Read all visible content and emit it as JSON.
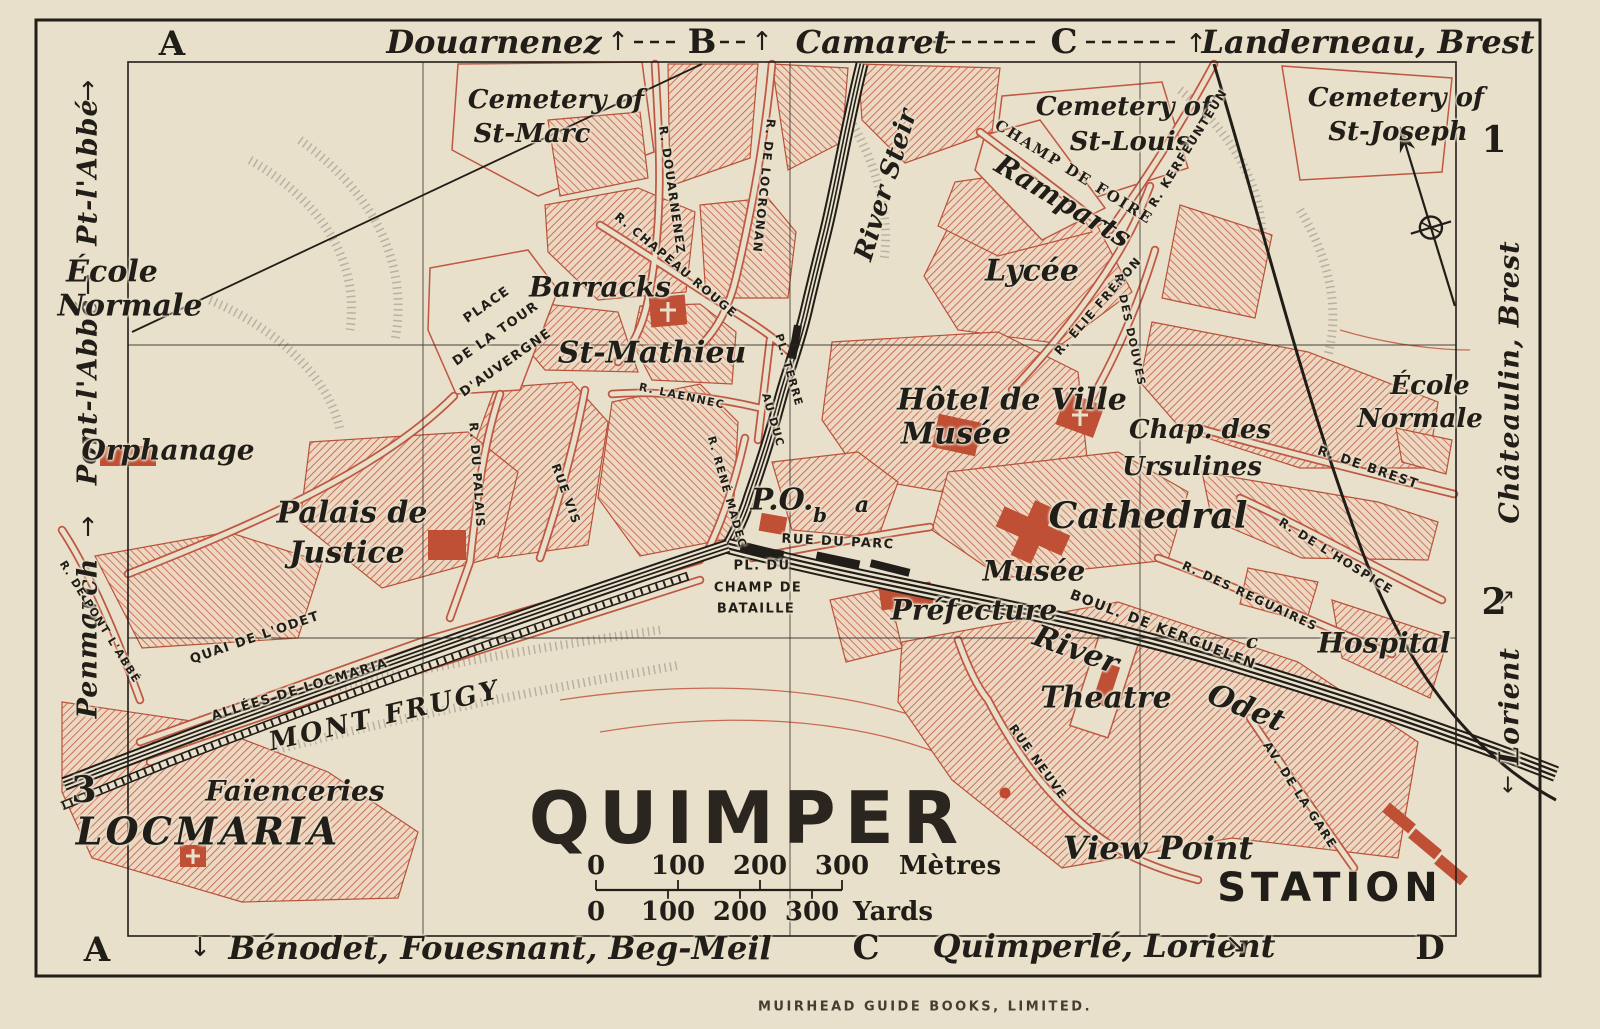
{
  "title": "QUIMPER",
  "publisher": "MUIRHEAD GUIDE BOOKS, LIMITED.",
  "colors": {
    "paper": "#e9e0cb",
    "ink": "#211d18",
    "street_red": "#bf5742",
    "hatch_red": "#c2573e",
    "building_red": "#bf4f35"
  },
  "scale": {
    "metres": {
      "ticks": [
        "0",
        "100",
        "200",
        "300"
      ],
      "unit": "Mètres"
    },
    "yards": {
      "ticks": [
        "0",
        "100",
        "200",
        "300"
      ],
      "unit": "Yards"
    }
  },
  "labels": [
    {
      "n": "grid-letter-a-top",
      "t": "A",
      "c": "g",
      "x": 172,
      "y": 44
    },
    {
      "n": "edge-douarnenez",
      "t": "Douarnenez",
      "c": "e",
      "x": 494,
      "y": 42
    },
    {
      "n": "arrow-up-douarnenez",
      "t": "↑",
      "c": "ar",
      "x": 618,
      "y": 42
    },
    {
      "n": "grid-letter-b-top",
      "t": "B",
      "c": "g",
      "x": 702,
      "y": 42
    },
    {
      "n": "arrow-up-camaret",
      "t": "↑",
      "c": "ar",
      "x": 762,
      "y": 42
    },
    {
      "n": "edge-camaret",
      "t": "Camaret",
      "c": "e",
      "x": 872,
      "y": 42
    },
    {
      "n": "grid-letter-c-top",
      "t": "C",
      "c": "g",
      "x": 1064,
      "y": 42
    },
    {
      "n": "arrow-up-landerneau",
      "t": "↑",
      "c": "ar",
      "x": 1196,
      "y": 44
    },
    {
      "n": "edge-landerneau-brest",
      "t": "Landerneau, Brest",
      "c": "e",
      "x": 1368,
      "y": 42
    },
    {
      "n": "grid-letter-a-bottom",
      "t": "A",
      "c": "g",
      "x": 97,
      "y": 950
    },
    {
      "n": "arrow-down-benodet",
      "t": "↓",
      "c": "ar",
      "x": 200,
      "y": 948
    },
    {
      "n": "edge-benodet",
      "t": "Bénodet, Fouesnant, Beg-Meil",
      "c": "e",
      "x": 500,
      "y": 948
    },
    {
      "n": "grid-letter-c-bottom",
      "t": "C",
      "c": "g",
      "x": 866,
      "y": 948
    },
    {
      "n": "edge-quimperle-lorient",
      "t": "Quimperlé, Lorient",
      "c": "e",
      "x": 1104,
      "y": 946
    },
    {
      "n": "arrow-se-quimperle",
      "t": "↘",
      "c": "ar",
      "x": 1236,
      "y": 944
    },
    {
      "n": "grid-letter-d-bottom",
      "t": "D",
      "c": "g",
      "x": 1430,
      "y": 948
    },
    {
      "n": "edge-pt-labbe",
      "t": "Pt-l'Abbé",
      "c": "v",
      "x": 88,
      "y": 172,
      "r": -90
    },
    {
      "n": "arrow-up-pt-labbe",
      "t": "↑",
      "c": "ar",
      "x": 88,
      "y": 92
    },
    {
      "n": "edge-pont-labbe",
      "t": "Pont-l'Abbé",
      "c": "v",
      "x": 88,
      "y": 392,
      "r": -90
    },
    {
      "n": "arrow-up-pont-labbe",
      "t": "↑",
      "c": "ar",
      "x": 88,
      "y": 286
    },
    {
      "n": "edge-penmarch",
      "t": "Penmarch",
      "c": "v",
      "x": 88,
      "y": 638,
      "r": -90
    },
    {
      "n": "arrow-up-penmarch",
      "t": "↑",
      "c": "ar",
      "x": 88,
      "y": 528
    },
    {
      "n": "row-number-3",
      "t": "3",
      "c": "n",
      "x": 84,
      "y": 790
    },
    {
      "n": "row-number-1",
      "t": "1",
      "c": "n",
      "x": 1494,
      "y": 140
    },
    {
      "n": "edge-chateaulin-brest",
      "t": "Châteaulin, Brest",
      "c": "v",
      "x": 1510,
      "y": 382,
      "r": -90
    },
    {
      "n": "arrow-chateaulin",
      "t": "↗",
      "c": "ar",
      "x": 1506,
      "y": 598,
      "s": 22
    },
    {
      "n": "row-number-2",
      "t": "2",
      "c": "n",
      "x": 1494,
      "y": 602
    },
    {
      "n": "edge-lorient",
      "t": "Lorient",
      "c": "v",
      "x": 1510,
      "y": 706,
      "r": -90
    },
    {
      "n": "arrow-down-lorient",
      "t": "↓",
      "c": "ar",
      "x": 1508,
      "y": 786,
      "s": 22
    },
    {
      "n": "cemetery-st-marc-line1",
      "t": "Cemetery of",
      "c": "p",
      "x": 556,
      "y": 100
    },
    {
      "n": "cemetery-st-marc-line2",
      "t": "St-Marc",
      "c": "p",
      "x": 532,
      "y": 134
    },
    {
      "n": "cemetery-st-louis-line1",
      "t": "Cemetery of",
      "c": "p",
      "x": 1124,
      "y": 107
    },
    {
      "n": "cemetery-st-louis-line2",
      "t": "St-Louis",
      "c": "p",
      "x": 1130,
      "y": 142
    },
    {
      "n": "cemetery-st-joseph-line1",
      "t": "Cemetery of",
      "c": "p",
      "x": 1396,
      "y": 98
    },
    {
      "n": "cemetery-st-joseph-line2",
      "t": "St-Joseph",
      "c": "p",
      "x": 1398,
      "y": 132
    },
    {
      "n": "ecole-normale-west-line1",
      "t": "École",
      "c": "p",
      "x": 112,
      "y": 272,
      "s": 30
    },
    {
      "n": "ecole-normale-west-line2",
      "t": "Normale",
      "c": "p",
      "x": 130,
      "y": 306,
      "s": 30
    },
    {
      "n": "orphanage",
      "t": "Orphanage",
      "c": "p",
      "x": 168,
      "y": 450,
      "s": 28
    },
    {
      "n": "palais-de-justice-line1",
      "t": "Palais de",
      "c": "p",
      "x": 352,
      "y": 513,
      "s": 30
    },
    {
      "n": "palais-de-justice-line2",
      "t": "Justice",
      "c": "p",
      "x": 347,
      "y": 553,
      "s": 30
    },
    {
      "n": "barracks",
      "t": "Barracks",
      "c": "p",
      "x": 600,
      "y": 287,
      "s": 28
    },
    {
      "n": "st-mathieu",
      "t": "St-Mathieu",
      "c": "p",
      "x": 652,
      "y": 353,
      "s": 30
    },
    {
      "n": "hotel-de-ville",
      "t": "Hôtel de Ville",
      "c": "p",
      "x": 1012,
      "y": 400,
      "s": 30
    },
    {
      "n": "musee-hotel-de-ville",
      "t": "Musée",
      "c": "p",
      "x": 956,
      "y": 434,
      "s": 30
    },
    {
      "n": "chap-des-ursulines-line1",
      "t": "Chap. des",
      "c": "p",
      "x": 1200,
      "y": 430
    },
    {
      "n": "chap-des-ursulines-line2",
      "t": "Ursulines",
      "c": "p",
      "x": 1192,
      "y": 467
    },
    {
      "n": "cathedral",
      "t": "Cathedral",
      "c": "p",
      "x": 1148,
      "y": 516,
      "s": 36
    },
    {
      "n": "musee-south",
      "t": "Musée",
      "c": "p",
      "x": 1034,
      "y": 571,
      "s": 28
    },
    {
      "n": "prefecture",
      "t": "Préfecture",
      "c": "p",
      "x": 974,
      "y": 610,
      "s": 28
    },
    {
      "n": "hospital",
      "t": "Hospital",
      "c": "p",
      "x": 1384,
      "y": 643,
      "s": 28
    },
    {
      "n": "theatre",
      "t": "Theatre",
      "c": "p",
      "x": 1106,
      "y": 698,
      "s": 30
    },
    {
      "n": "lycee",
      "t": "Lycée",
      "c": "p",
      "x": 1032,
      "y": 271,
      "s": 30
    },
    {
      "n": "ecole-normale-east-line1",
      "t": "École",
      "c": "p",
      "x": 1430,
      "y": 386
    },
    {
      "n": "ecole-normale-east-line2",
      "t": "Normale",
      "c": "p",
      "x": 1420,
      "y": 419
    },
    {
      "n": "faiencieries",
      "t": "Faïenceries",
      "c": "p",
      "x": 295,
      "y": 791,
      "s": 28
    },
    {
      "n": "view-point",
      "t": "View Point",
      "c": "p",
      "x": 1158,
      "y": 848,
      "s": 32
    },
    {
      "n": "ramparts",
      "t": "Ramparts",
      "c": "p",
      "x": 1063,
      "y": 201,
      "r": 31,
      "s": 28
    },
    {
      "n": "river-steir",
      "t": "River Steir",
      "c": "p",
      "x": 886,
      "y": 185,
      "r": -73
    },
    {
      "n": "river-odet-word1",
      "t": "River",
      "c": "p",
      "x": 1076,
      "y": 650,
      "r": 20,
      "s": 30
    },
    {
      "n": "river-odet-word2",
      "t": "Odet",
      "c": "p",
      "x": 1246,
      "y": 708,
      "r": 22,
      "s": 30
    },
    {
      "n": "mont-frugy",
      "t": "MONT FRUGY",
      "c": "cap",
      "x": 385,
      "y": 716,
      "r": -13
    },
    {
      "n": "locmaria",
      "t": "LOCMARIA",
      "c": "big",
      "x": 208,
      "y": 831
    },
    {
      "n": "station",
      "t": "STATION",
      "c": "sta",
      "x": 1330,
      "y": 888
    },
    {
      "n": "post-office",
      "t": "P.O.",
      "c": "p",
      "x": 782,
      "y": 500,
      "s": 30
    },
    {
      "n": "marker-a",
      "t": "a",
      "c": "sm",
      "x": 862,
      "y": 505,
      "s": 22
    },
    {
      "n": "marker-b",
      "t": "b",
      "c": "sm",
      "x": 820,
      "y": 515
    },
    {
      "n": "marker-c",
      "t": "c",
      "c": "sm",
      "x": 1252,
      "y": 641
    },
    {
      "n": "champ-de-foire",
      "t": "CHAMP DE FOIRE",
      "c": "sc",
      "x": 1074,
      "y": 172,
      "r": 32
    },
    {
      "n": "street-r-douarnenez",
      "t": "R. DOUARNENEZ",
      "c": "st",
      "x": 672,
      "y": 190,
      "r": 82
    },
    {
      "n": "street-r-de-locronan",
      "t": "R. DE LOCRONAN",
      "c": "st",
      "x": 764,
      "y": 186,
      "r": 96
    },
    {
      "n": "street-r-chapeau-rouge",
      "t": "R. CHAPEAU ROUGE",
      "c": "st",
      "x": 676,
      "y": 265,
      "r": 40
    },
    {
      "n": "street-place-tour-line1",
      "t": "PLACE",
      "c": "st",
      "x": 487,
      "y": 305,
      "r": -35,
      "s": 13
    },
    {
      "n": "street-place-tour-line2",
      "t": "DE LA TOUR",
      "c": "st",
      "x": 496,
      "y": 334,
      "r": -35,
      "s": 13
    },
    {
      "n": "street-place-tour-line3",
      "t": "D'AUVERGNE",
      "c": "st",
      "x": 506,
      "y": 363,
      "r": -35,
      "s": 13
    },
    {
      "n": "street-r-laennec",
      "t": "R. LAENNEC",
      "c": "st",
      "x": 682,
      "y": 396,
      "r": 12,
      "s": 11
    },
    {
      "n": "street-r-du-palais",
      "t": "R. DU PALAIS",
      "c": "st",
      "x": 477,
      "y": 475,
      "r": 86
    },
    {
      "n": "street-rue-vis",
      "t": "RUE VIS",
      "c": "st",
      "x": 566,
      "y": 494,
      "r": 70
    },
    {
      "n": "street-r-rene-madec",
      "t": "R. RENÉ MADEC",
      "c": "st",
      "x": 727,
      "y": 492,
      "r": 74,
      "s": 11
    },
    {
      "n": "street-pl-terre",
      "t": "PL. TERRE",
      "c": "st",
      "x": 789,
      "y": 370,
      "r": 74,
      "s": 11
    },
    {
      "n": "street-au-duc",
      "t": "AU DUC",
      "c": "st",
      "x": 773,
      "y": 420,
      "r": 74,
      "s": 11
    },
    {
      "n": "street-rue-du-parc",
      "t": "RUE DU PARC",
      "c": "st",
      "x": 838,
      "y": 542,
      "r": 3,
      "s": 13
    },
    {
      "n": "street-pl-du-champ-line1",
      "t": "PL. DU",
      "c": "st",
      "x": 762,
      "y": 566,
      "s": 13
    },
    {
      "n": "street-pl-du-champ-line2",
      "t": "CHAMP DE",
      "c": "st",
      "x": 758,
      "y": 588,
      "s": 13
    },
    {
      "n": "street-pl-du-champ-line3",
      "t": "BATAILLE",
      "c": "st",
      "x": 756,
      "y": 609,
      "s": 13
    },
    {
      "n": "street-quai-de-lodet",
      "t": "QUAI DE L'ODET",
      "c": "st",
      "x": 255,
      "y": 638,
      "r": -19,
      "s": 13
    },
    {
      "n": "street-allees-de-locmaria",
      "t": "ALLÉES DE LOCMARIA",
      "c": "st",
      "x": 300,
      "y": 690,
      "r": -17,
      "s": 13
    },
    {
      "n": "street-r-de-pont-labbe",
      "t": "R. DE PONT L'ABBÉ",
      "c": "st",
      "x": 100,
      "y": 622,
      "r": 58,
      "s": 11
    },
    {
      "n": "street-boul-de-kerguelen",
      "t": "BOUL. DE KERGUELEN",
      "c": "st",
      "x": 1163,
      "y": 630,
      "r": 21,
      "s": 14
    },
    {
      "n": "street-r-des-reguaires",
      "t": "R. DES REGUAIRES",
      "c": "st",
      "x": 1250,
      "y": 596,
      "r": 25
    },
    {
      "n": "street-r-de-lhospice",
      "t": "R. DE L'HOSPICE",
      "c": "st",
      "x": 1336,
      "y": 556,
      "r": 32
    },
    {
      "n": "street-r-de-brest",
      "t": "R. DE BREST",
      "c": "st",
      "x": 1368,
      "y": 468,
      "r": 19,
      "s": 13
    },
    {
      "n": "street-r-elie-freron",
      "t": "R. ÉLIE FRÉRON",
      "c": "st",
      "x": 1098,
      "y": 306,
      "r": -49
    },
    {
      "n": "street-r-des-douves",
      "t": "R. DES DOUVES",
      "c": "st",
      "x": 1130,
      "y": 330,
      "r": 78,
      "s": 11
    },
    {
      "n": "street-r-kerfeunteun",
      "t": "R. KERFEUNTEUN",
      "c": "st",
      "x": 1188,
      "y": 148,
      "r": -58
    },
    {
      "n": "street-rue-neuve",
      "t": "RUE NEUVE",
      "c": "st",
      "x": 1038,
      "y": 762,
      "r": 54
    },
    {
      "n": "street-av-de-la-gare",
      "t": "AV. DE LA GARE",
      "c": "st",
      "x": 1300,
      "y": 795,
      "r": 57
    }
  ]
}
